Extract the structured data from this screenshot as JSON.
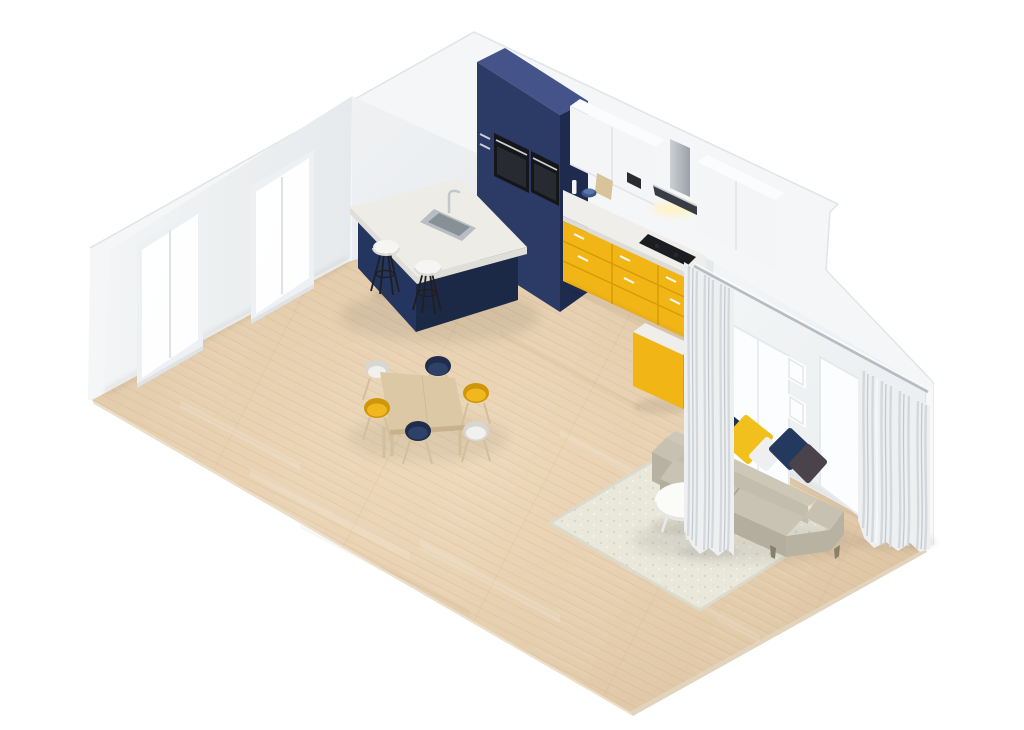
{
  "scene": {
    "description": "Isometric 3D render of a modern open-plan apartment with kitchen, dining area and living room",
    "style": "isometric cutaway room mockup on white background",
    "rooms": [
      "kitchen",
      "dining area",
      "living room"
    ],
    "objects": [
      "white left wall with two glazed sliding doors",
      "white back wall with kitchen run",
      "white right wall with sliding glass panels, two picture frames and curtains",
      "light oak plank floor",
      "navy tall kitchen cabinet with two built-in black ovens",
      "white upper cabinets and stainless chimney range hood",
      "white countertop with yellow base cabinets and black cooktop",
      "blue bowl, white bottle and wooden cutting board on counter",
      "kitchen island with navy base, stone top, sink and chrome faucet",
      "two white bar stools with black legs",
      "light wood dining table with six shell chairs (white, navy, yellow)",
      "greige two-seat sofa with navy, yellow, white and brown cushions",
      "round white coffee table",
      "cream shaggy rug",
      "two light grey curtains on ceiling rail"
    ]
  },
  "colors": {
    "background": "#ffffff",
    "wallMass": "#f5f6f7",
    "wallEdgeLine": "#e2e6e8",
    "leftWallLight": "#f2f4f5",
    "leftWallDark": "#e7eaec",
    "backWallLight": "#eff1f3",
    "backWallDark": "#e2e6e9",
    "rightWallLight": "#f3f5f6",
    "rightWallDark": "#e9edef",
    "cutFace": "#f7f8f9",
    "floorLight": "#eed9ba",
    "floorMid": "#e4cdad",
    "floorDark": "#d8bf9d",
    "floorEdgeFront": "#ecdfca",
    "floorEdgeRight": "#e2d3bc",
    "plankSeam": "#b08a5e",
    "doorFrame": "#eef1f3",
    "glassWhite": "#fdfeff",
    "frameLine": "#dfe3e6",
    "navyTop": "#44548a",
    "navyFront": "#2c3b66",
    "navySide": "#1e2b4e",
    "islandNavyFront": "#243560",
    "islandNavySide": "#1b2947",
    "ovenBlack": "#15161a",
    "ovenGlass": "#272a30",
    "steelLight": "#ccd0d5",
    "steelDark": "#9ba1a8",
    "hoodDark": "#383d43",
    "hoodGlow": "#fff3c4",
    "counterWhite": "#efeeea",
    "counterEdge": "#dddcd6",
    "yellowFront": "#f2b516",
    "yellowSide": "#d89c06",
    "yellowLine": "#cf9404",
    "handleWhite": "#fafafa",
    "cabWhite": "#f4f5f6",
    "cabWhiteTop": "#fbfcfd",
    "cabLine": "#e2e5e8",
    "cooktopBlack": "#1b1d21",
    "applianceDark": "#2a2c30",
    "bowlBlue": "#3a5788",
    "boardWood": "#d8c39a",
    "bottleWhite": "#f4f5f4",
    "islandTopLight": "#edece7",
    "islandTopDark": "#dfded8",
    "sinkSteel": "#b7bdc3",
    "sinkInner": "#878f97",
    "faucetSteel": "#c2c7cc",
    "stoolSeat": "#f5f5f3",
    "stoolSeatEdge": "#dedcd6",
    "stoolLeg": "#1f1f21",
    "tableWood": "#dcc8a4",
    "tableEdge": "#c9b28b",
    "woodLeg": "#d2bf9b",
    "chairWhite": "#f1f1ef",
    "chairWhiteRim": "#d7d6d0",
    "chairNavy": "#2e4168",
    "chairNavyRim": "#1f2c4a",
    "chairYellow": "#f2b71f",
    "chairYellowRim": "#ce9709",
    "rugBase": "#e9e8db",
    "rugShade": "#dcdbcb",
    "speckleDark": "#c9c8b4",
    "speckleLight": "#f6f5ec",
    "sofaTop": "#cdc7b8",
    "sofaBack": "#c3bdae",
    "sofaSeat": "#c9c3b4",
    "sofaFront": "#b4ae9e",
    "sofaArm": "#c7c1b2",
    "sofaArmFront": "#b8b2a2",
    "sofaSeam": "#a9a393",
    "sofaLeg": "#85806f",
    "pillowNavy": "#1d3356",
    "pillowYellow": "#f2c01d",
    "pillowWhite": "#eeefee",
    "pillowNavy2": "#23395e",
    "pillowDark": "#4a434b",
    "coffeeTableTop": "#fbfbfa",
    "coffeeTableRim": "#e6e6e2",
    "coffeeTableLeg": "#e9e9e6",
    "curtain": "#edeff1",
    "curtainFold": "#d3d8dc",
    "curtainFoldDark": "#c2c8cd",
    "curtainHi": "#f7f8fa",
    "rail": "#b6bcc2",
    "panelWhite": "#fbfdfe",
    "panelFrame": "#e6eaec",
    "picFrame": "#fdfdfd",
    "picLine": "#e3e6e9",
    "shadow": "#3a3429"
  }
}
